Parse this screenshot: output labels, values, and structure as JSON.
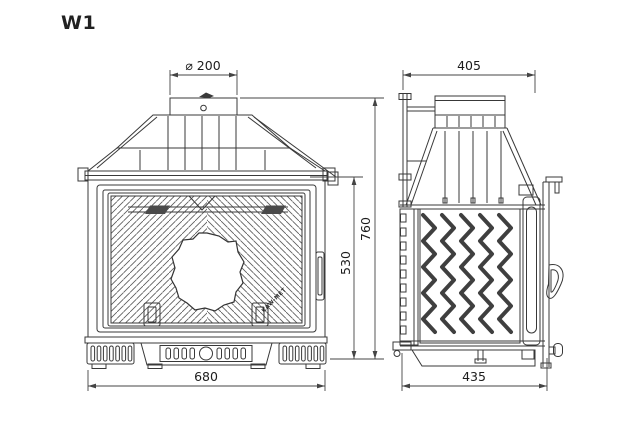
{
  "title": "W1",
  "brand_mark": "KAW-MET",
  "dimensions": {
    "flue_diameter": "⌀ 200",
    "depth_top": "405",
    "total_height": "760",
    "body_height": "530",
    "front_width": "680",
    "base_depth": "435"
  },
  "colors": {
    "line": "#383838",
    "hatch": "#5a5a5a",
    "fin": "#3f3f3f",
    "background": "#ffffff",
    "text": "#1c1c1c"
  }
}
